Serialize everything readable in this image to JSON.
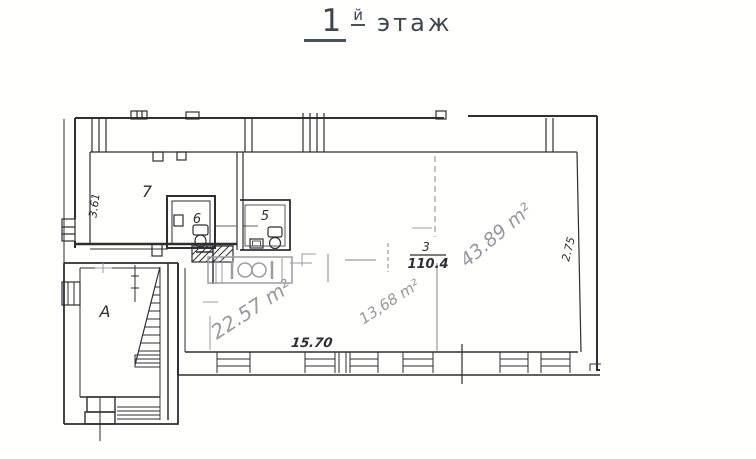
{
  "title": {
    "number": "1",
    "suffix": "й",
    "word": "этаж"
  },
  "plan": {
    "room_labels": {
      "room7": "7",
      "room6": "6",
      "room5": "5",
      "roomA": "А",
      "room3_number": "3",
      "room3_area": "110.4"
    },
    "dimensions": {
      "left_wall": "3.61",
      "right_wall": "2.75",
      "bottom": "15.70"
    },
    "pencil_areas": {
      "area_22": "22.57 m²",
      "area_13": "13,68 m²",
      "area_43": "43.89 m²"
    },
    "colors": {
      "ink": "#2e2e33",
      "pencil": "#9b9ba2",
      "title": "#3e4550",
      "paper": "#fffffe"
    }
  }
}
